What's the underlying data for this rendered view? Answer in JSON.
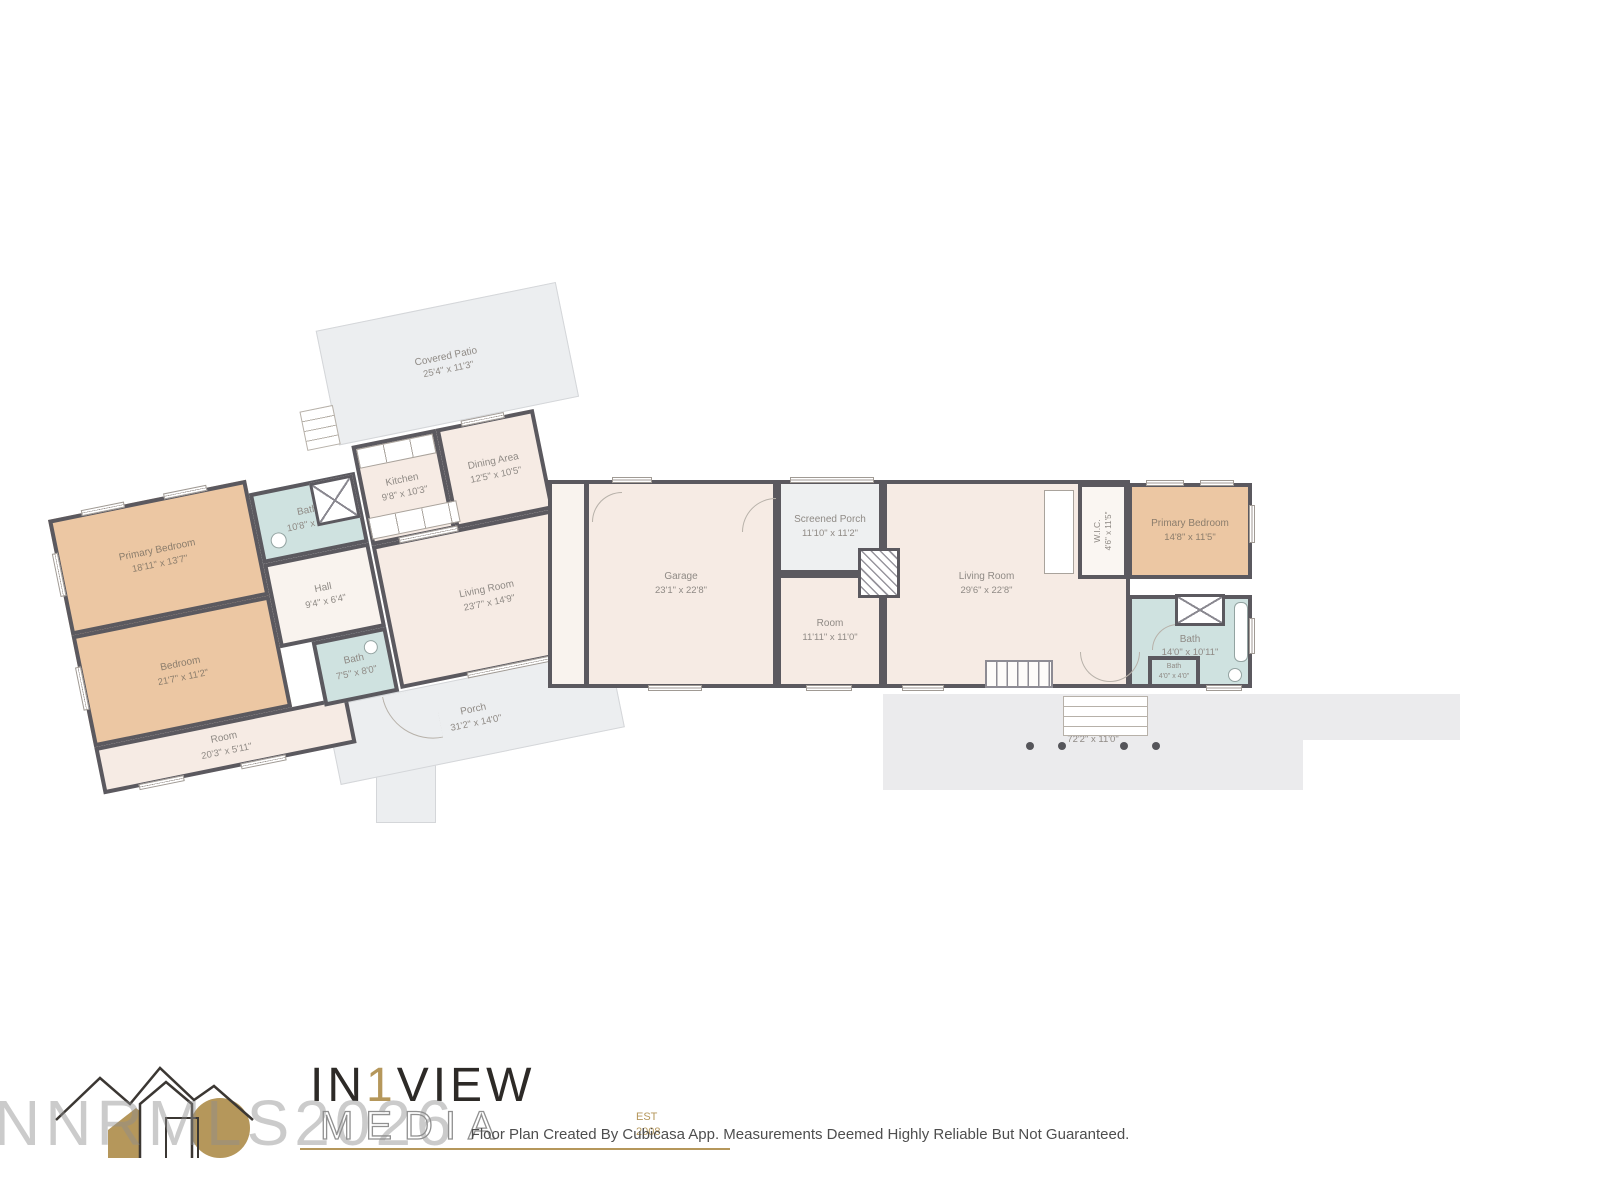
{
  "rooms": {
    "lw_primary_bedroom": {
      "name": "Primary Bedroom",
      "dims": "18'11\" x 13'7\""
    },
    "lw_bedroom": {
      "name": "Bedroom",
      "dims": "21'7\" x 11'2\""
    },
    "lw_room": {
      "name": "Room",
      "dims": "20'3\" x 5'11\""
    },
    "lw_bath1": {
      "name": "Bath",
      "dims": "10'8\" x 7'4\""
    },
    "lw_hall": {
      "name": "Hall",
      "dims": "9'4\" x 6'4\""
    },
    "lw_bath2": {
      "name": "Bath",
      "dims": "7'5\" x 8'0\""
    },
    "lw_kitchen": {
      "name": "Kitchen",
      "dims": "9'8\" x 10'3\""
    },
    "lw_dining": {
      "name": "Dining Area",
      "dims": "12'5\" x 10'5\""
    },
    "lw_living": {
      "name": "Living Room",
      "dims": "23'7\" x 14'9\""
    },
    "lw_patio": {
      "name": "Covered Patio",
      "dims": "25'4\" x 11'3\""
    },
    "lw_porch": {
      "name": "Porch",
      "dims": "31'2\" x 14'0\""
    },
    "rb_garage": {
      "name": "Garage",
      "dims": "23'1\" x 22'8\""
    },
    "rb_screened_porch": {
      "name": "Screened Porch",
      "dims": "11'10\" x 11'2\""
    },
    "rb_room": {
      "name": "Room",
      "dims": "11'11\" x 11'0\""
    },
    "rb_living": {
      "name": "Living Room",
      "dims": "29'6\" x 22'8\""
    },
    "rb_wic": {
      "name": "W.I.C.",
      "dims": "4'6\" x 11'5\""
    },
    "rb_primary_bedroom": {
      "name": "Primary Bedroom",
      "dims": "14'8\" x 11'5\""
    },
    "rb_bath": {
      "name": "Bath",
      "dims": "14'0\" x 10'11\""
    },
    "rb_bath_small": {
      "name": "Bath",
      "dims": "4'0\" x 4'0\""
    },
    "rb_porch": {
      "name": "Porch",
      "dims": "72'2\" x 11'0\""
    }
  },
  "branding": {
    "watermark": "NNRMLS2026",
    "logo": {
      "prefix": "IN",
      "one": "1",
      "suffix": "VIEW",
      "subtitle": "MEDIA",
      "est": "EST",
      "year": "2008"
    }
  },
  "footer": {
    "text": "Floor Plan Created By Cubicasa App. Measurements Deemed Highly Reliable But Not Guaranteed."
  },
  "colors": {
    "wall": "#5b595f",
    "bedroom_fill": "#ecc7a3",
    "room_fill": "#f6ebe4",
    "bath_fill": "#cfe2e0",
    "outdoor_fill": "#eceef0",
    "porch_slab": "#ebebed",
    "label_text": "#8f8a85",
    "accent_gold": "#b5975b"
  }
}
